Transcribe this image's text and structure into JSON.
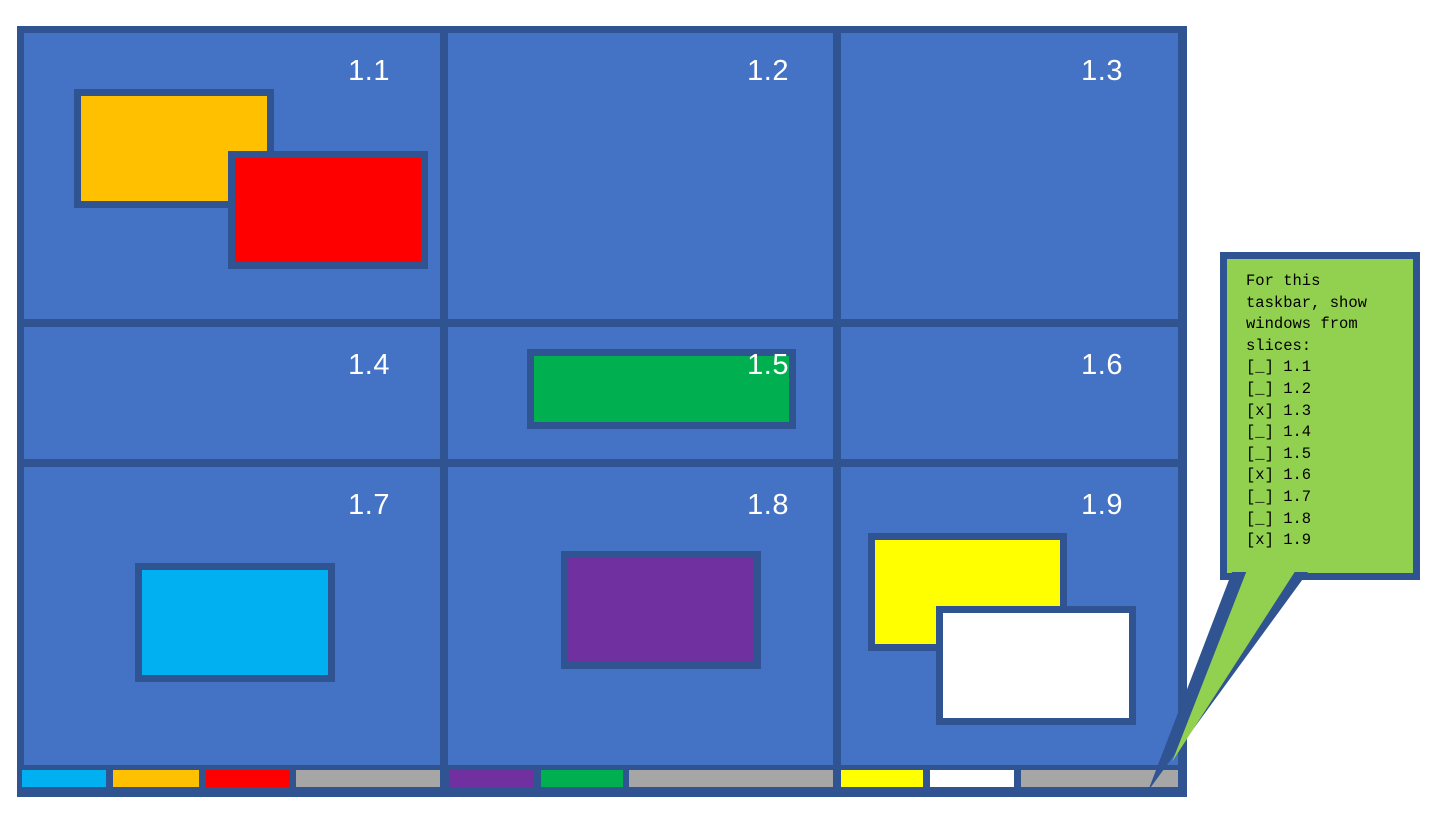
{
  "desktop": {
    "slices": [
      {
        "label": "1.1"
      },
      {
        "label": "1.2"
      },
      {
        "label": "1.3"
      },
      {
        "label": "1.4"
      },
      {
        "label": "1.5"
      },
      {
        "label": "1.6"
      },
      {
        "label": "1.7"
      },
      {
        "label": "1.8"
      },
      {
        "label": "1.9"
      }
    ]
  },
  "windows": [
    {
      "name": "orange",
      "slice": "1.1",
      "color": "#FFC000"
    },
    {
      "name": "red",
      "slice": "1.1",
      "color": "#FF0000"
    },
    {
      "name": "green",
      "slice": "1.5",
      "color": "#00B050"
    },
    {
      "name": "cyan",
      "slice": "1.7",
      "color": "#00B0F0"
    },
    {
      "name": "purple",
      "slice": "1.8",
      "color": "#7030A0"
    },
    {
      "name": "yellow",
      "slice": "1.9",
      "color": "#FFFF00"
    },
    {
      "name": "white",
      "slice": "1.9",
      "color": "#FFFFFF"
    }
  ],
  "taskbar": {
    "groups": [
      {
        "buttons": [
          {
            "window": "cyan",
            "color": "#00B0F0"
          },
          {
            "window": "orange",
            "color": "#FFC000"
          },
          {
            "window": "red",
            "color": "#FF0000"
          }
        ],
        "filler_color": "#A6A6A6"
      },
      {
        "buttons": [
          {
            "window": "purple",
            "color": "#7030A0"
          },
          {
            "window": "green",
            "color": "#00B050"
          }
        ],
        "filler_color": "#A6A6A6"
      },
      {
        "buttons": [
          {
            "window": "yellow",
            "color": "#FFFF00"
          },
          {
            "window": "white",
            "color": "#FFFFFF"
          }
        ],
        "filler_color": "#A6A6A6"
      }
    ]
  },
  "callout": {
    "prompt_lines": [
      "For this",
      "taskbar, show",
      "windows from",
      "slices:"
    ],
    "items": [
      {
        "slice": "1.1",
        "checked": false,
        "display": "[_] 1.1"
      },
      {
        "slice": "1.2",
        "checked": false,
        "display": "[_] 1.2"
      },
      {
        "slice": "1.3",
        "checked": true,
        "display": "[x] 1.3"
      },
      {
        "slice": "1.4",
        "checked": false,
        "display": "[_] 1.4"
      },
      {
        "slice": "1.5",
        "checked": false,
        "display": "[_] 1.5"
      },
      {
        "slice": "1.6",
        "checked": true,
        "display": "[x] 1.6"
      },
      {
        "slice": "1.7",
        "checked": false,
        "display": "[_] 1.7"
      },
      {
        "slice": "1.8",
        "checked": false,
        "display": "[_] 1.8"
      },
      {
        "slice": "1.9",
        "checked": true,
        "display": "[x] 1.9"
      }
    ]
  },
  "colors": {
    "slice_fill": "#4472C4",
    "chrome_border": "#2F5491",
    "taskbar_filler": "#A6A6A6",
    "callout_fill": "#92D050",
    "callout_text": "#000000",
    "slice_label_text": "#FFFFFF"
  }
}
